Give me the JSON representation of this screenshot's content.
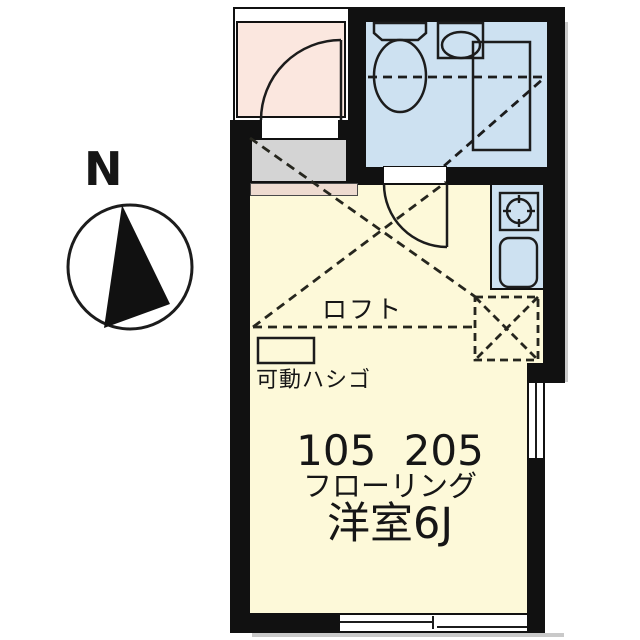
{
  "compass": {
    "north_label": "N"
  },
  "plan": {
    "loft_label": "ロフト",
    "ladder_label": "可動ハシゴ",
    "unit_numbers": "105 205",
    "flooring_label": "フローリング",
    "room_type_label": "洋室6J"
  },
  "legend": {
    "fixtures": [
      "toilet-icon",
      "washbasin-icon",
      "bathtub-icon",
      "stove-icon",
      "kitchen-sink-icon",
      "ladder-icon",
      "compass-needle-icon"
    ]
  },
  "colors": {
    "wall": "#111111",
    "line": "#1c1c1c",
    "porch-pink": "#fbe7df",
    "wet-blue": "#cde1f1",
    "room-yellow": "#fdf9d9",
    "genkan-gray": "#d4d4d4",
    "step-tan": "#eedbd0"
  }
}
